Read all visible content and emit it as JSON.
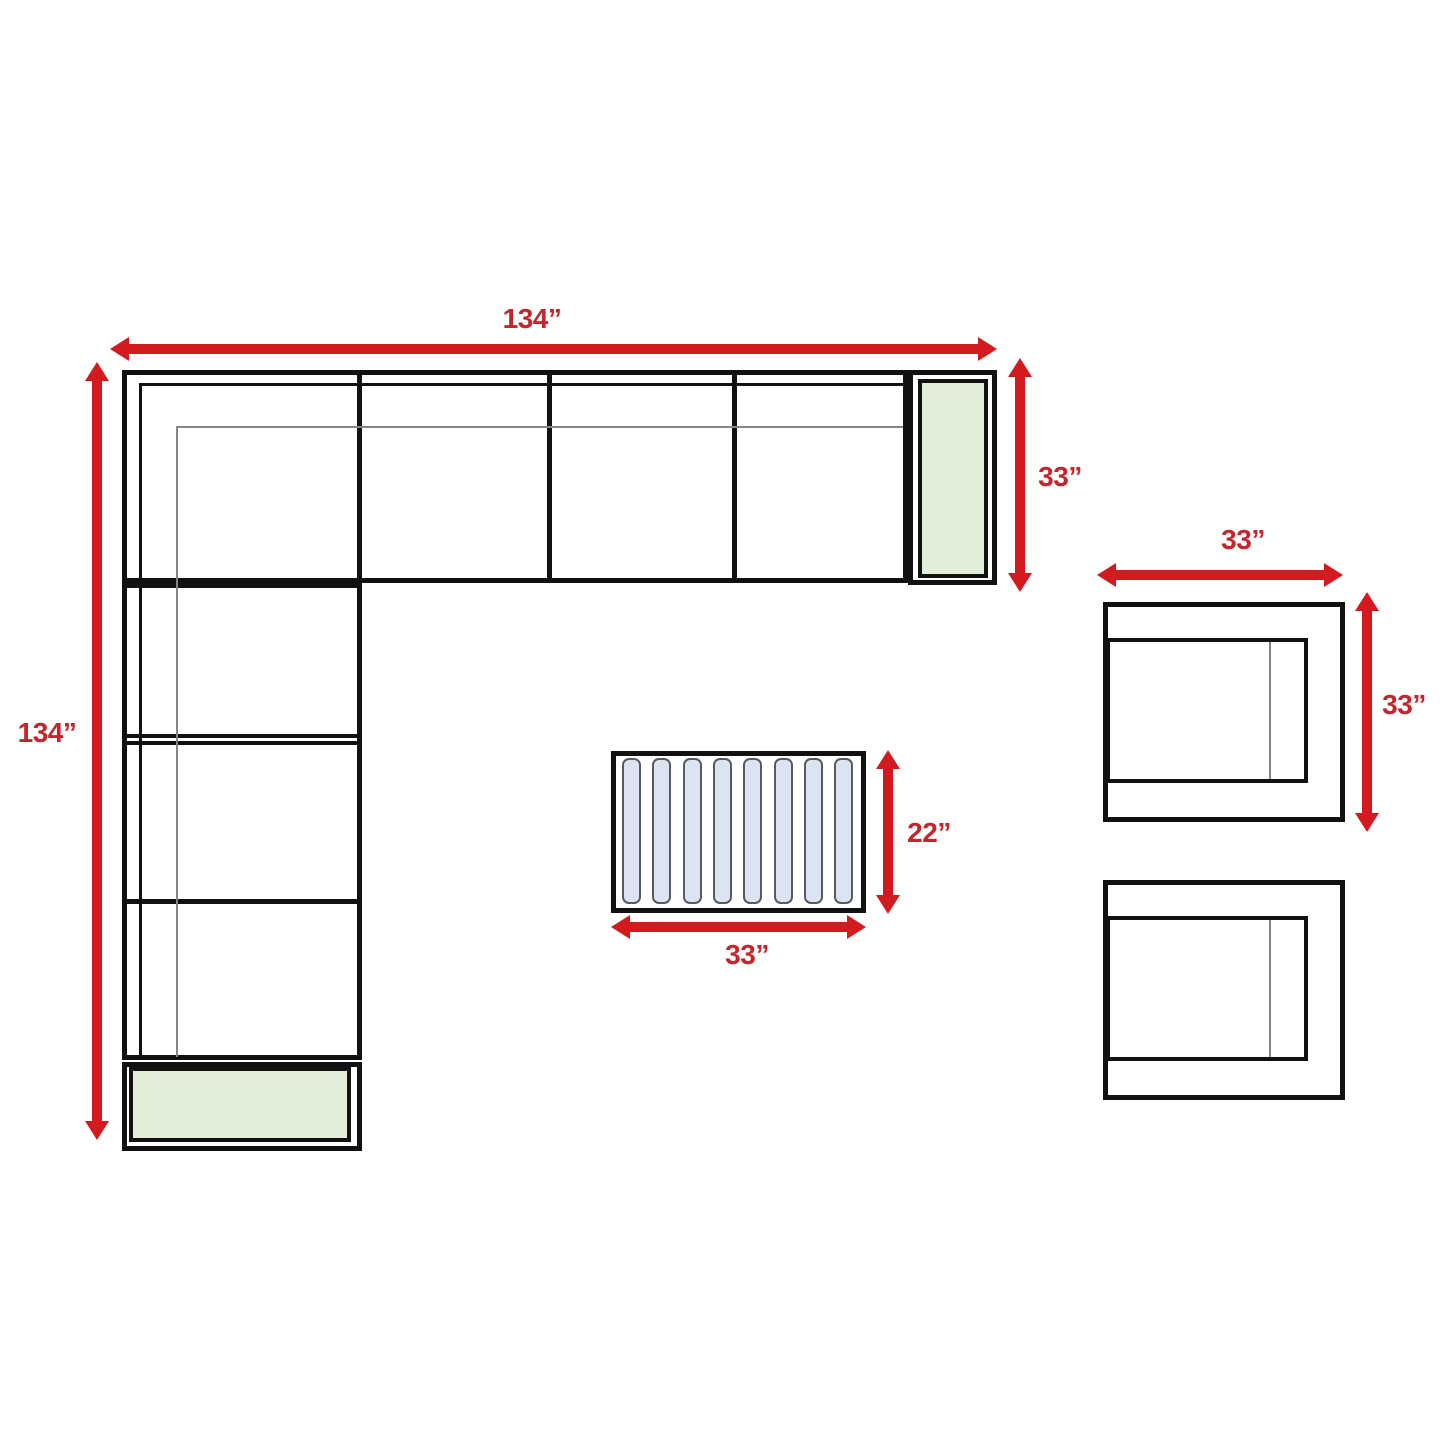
{
  "diagram": {
    "type": "furniture-dimension-floor-plan",
    "labels": {
      "sectional_width": "134”",
      "sectional_depth": "134”",
      "sectional_end_depth": "33”",
      "chair_width": "33”",
      "chair_depth": "33”",
      "table_depth": "22”",
      "table_width": "33”"
    },
    "table": {
      "slat_count": 8,
      "slat_pitch_px": 30.3,
      "slat_left_start_px": 6
    },
    "colors": {
      "arrow_red": "#d31a1e",
      "label_red": "#c5262b",
      "line_black": "#111111",
      "seam_gray": "#858585",
      "cushion_green": "#e3eed9",
      "slat_fill": "#dce3f1",
      "slat_border": "#565a61",
      "background": "#ffffff"
    }
  }
}
